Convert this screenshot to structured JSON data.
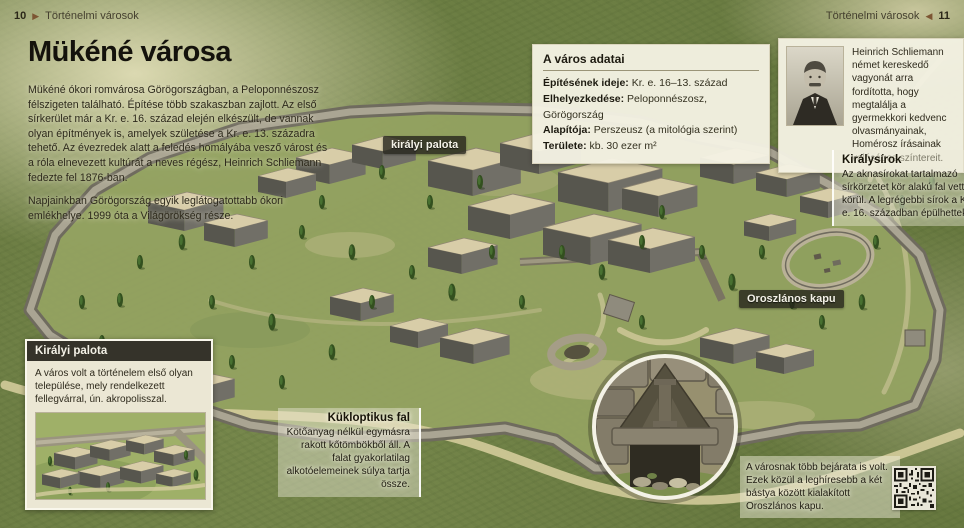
{
  "header": {
    "left": {
      "page_number": "10",
      "section_title": "Történelmi városok"
    },
    "right": {
      "page_number": "11",
      "section_title": "Történelmi városok"
    }
  },
  "icons": {
    "arrow_right": "▶",
    "arrow_left": "◀"
  },
  "article": {
    "title": "Mükéné városa",
    "paragraph_1": "Mükéné ókori romvárosa Görögországban, a Peloponnészosz félszigeten található. Építése több szakaszban zajlott. Az első sírkerület már a Kr. e. 16. század elején elkészült, de vannak olyan építmények is, amelyek születése a Kr. e. 13. századra tehető. Az évezredek alatt a feledés homályába vesző várost és a róla elnevezett kultúrát a neves régész, Heinrich Schliemann fedezte fel 1876-ban.",
    "paragraph_2": "Napjainkban Görögország egyik leglátogatottabb ókori emlékhelye. 1999 óta a Világörökség része."
  },
  "facts_box": {
    "title": "A város adatai",
    "rows": [
      {
        "label": "Építésének ideje:",
        "value": " Kr. e. 16–13. század"
      },
      {
        "label": "Elhelyezkedése:",
        "value": " Peloponnészosz, Görögország"
      },
      {
        "label": "Alapítója:",
        "value": " Perszeusz (a mitológia szerint)"
      },
      {
        "label": "Területe:",
        "value": " kb. 30 ezer m²"
      }
    ]
  },
  "schliemann_note": {
    "text": "Heinrich Schliemann német kereskedő vagyonát arra fordította, hogy megtalálja a gyermekkori kedvenc olvasmányainak, Homérosz írásainak valóságos színtereit."
  },
  "royal_tombs_note": {
    "title": "Királysírok",
    "text": "Az aknasírokat tartalmazó sírkörzetet kör alakú fal vette körül. A legrégebbi sírok a Kr. e. 16. században épülhettek."
  },
  "map_labels": {
    "royal_palace": "királyi palota",
    "lion_gate": "Oroszlános kapu"
  },
  "royal_palace_box": {
    "title": "Királyi palota",
    "text": "A város volt a történelem első olyan települése, mely rendelkezett fellegvárral, ún. akropolisszal."
  },
  "cyclopean_wall_note": {
    "title": "Kükloptikus fal",
    "text": "Kötőanyag nélkül egymásra rakott kőtömbökből áll. A falat gyakorlatilag alkotóelemeinek súlya tartja össze."
  },
  "entrances_note": {
    "text": "A városnak több bejárata is volt. Ezek közül a leghíresebb a két bástya között kialakított Oroszlános kapu."
  },
  "colors": {
    "accent_brown": "#7d5633",
    "box_bg": "#f2efe2",
    "badge_bg": "rgba(38,36,28,0.8)",
    "grass": "#73854a",
    "wall_stone": "#8f8b7d"
  }
}
